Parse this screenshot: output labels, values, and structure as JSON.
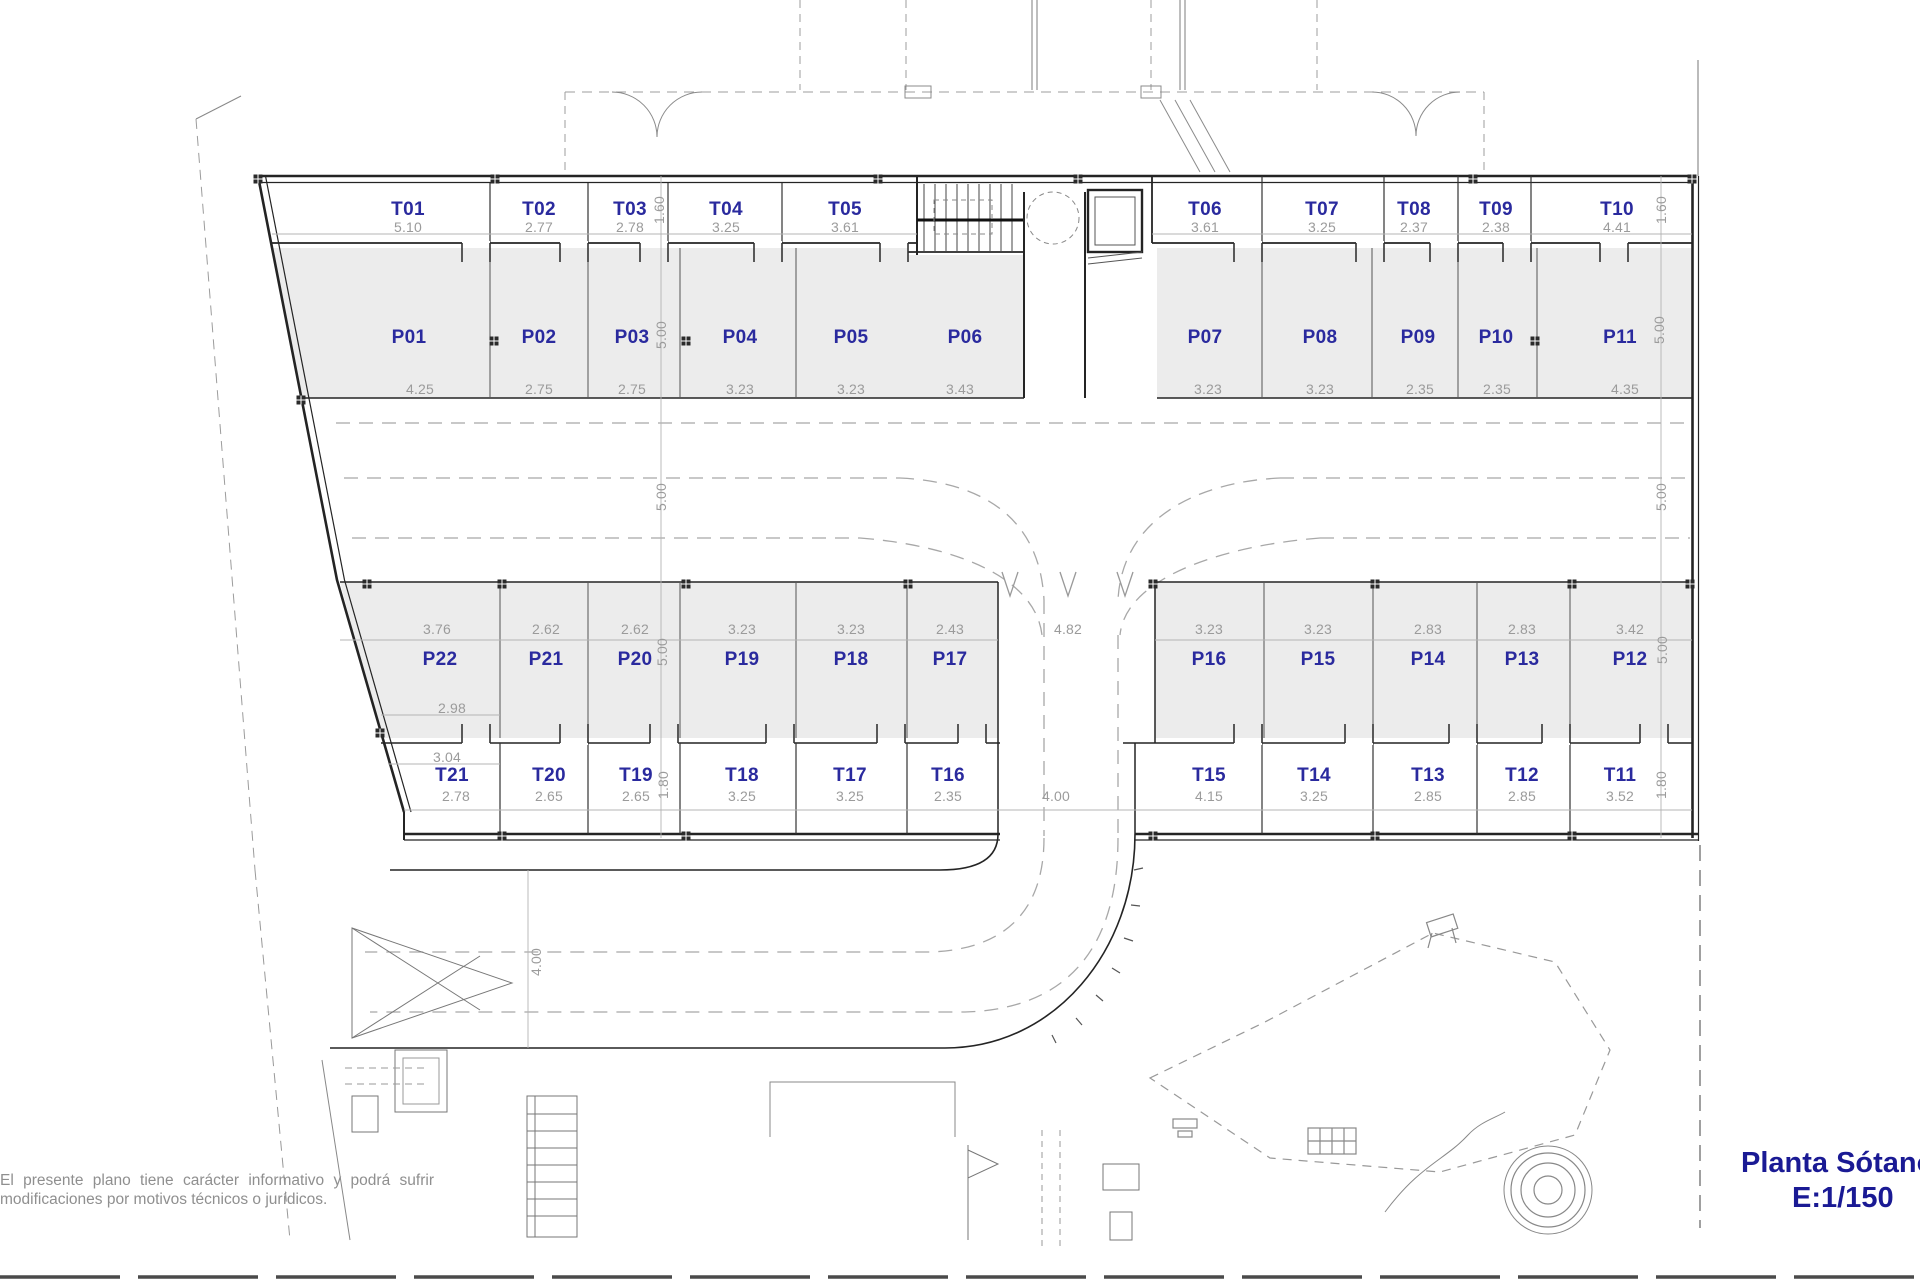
{
  "title": {
    "name": "Planta Sótano",
    "scale": "E:1/150"
  },
  "disclaimer": "El presente plano tiene carácter informativo y podrá sufrir modificaciones por motivos técnicos o jurídicos.",
  "colors": {
    "label_blue": "#2a2a9e",
    "title_blue": "#1a1a94",
    "dim_gray": "#9b9b9b",
    "stall_fill": "#ececec",
    "wall": "#242424"
  },
  "storage_top": [
    {
      "id": "T01",
      "w": "5.10"
    },
    {
      "id": "T02",
      "w": "2.77"
    },
    {
      "id": "T03",
      "w": "2.78"
    },
    {
      "id": "T04",
      "w": "3.25"
    },
    {
      "id": "T05",
      "w": "3.61"
    },
    {
      "id": "T06",
      "w": "3.61"
    },
    {
      "id": "T07",
      "w": "3.25"
    },
    {
      "id": "T08",
      "w": "2.37"
    },
    {
      "id": "T09",
      "w": "2.38"
    },
    {
      "id": "T10",
      "w": "4.41"
    }
  ],
  "parking_top": [
    {
      "id": "P01",
      "w": "4.25"
    },
    {
      "id": "P02",
      "w": "2.75"
    },
    {
      "id": "P03",
      "w": "2.75"
    },
    {
      "id": "P04",
      "w": "3.23"
    },
    {
      "id": "P05",
      "w": "3.23"
    },
    {
      "id": "P06",
      "w": "3.43"
    },
    {
      "id": "P07",
      "w": "3.23"
    },
    {
      "id": "P08",
      "w": "3.23"
    },
    {
      "id": "P09",
      "w": "2.35"
    },
    {
      "id": "P10",
      "w": "2.35"
    },
    {
      "id": "P11",
      "w": "4.35"
    }
  ],
  "parking_bottom": [
    {
      "id": "P22",
      "w": "3.76"
    },
    {
      "id": "P21",
      "w": "2.62"
    },
    {
      "id": "P20",
      "w": "2.62"
    },
    {
      "id": "P19",
      "w": "3.23"
    },
    {
      "id": "P18",
      "w": "3.23"
    },
    {
      "id": "P17",
      "w": "2.43"
    },
    {
      "id": "P16",
      "w": "3.23"
    },
    {
      "id": "P15",
      "w": "3.23"
    },
    {
      "id": "P14",
      "w": "2.83"
    },
    {
      "id": "P13",
      "w": "2.83"
    },
    {
      "id": "P12",
      "w": "3.42"
    }
  ],
  "storage_bottom": [
    {
      "id": "T21",
      "w": "2.78"
    },
    {
      "id": "T20",
      "w": "2.65"
    },
    {
      "id": "T19",
      "w": "2.65"
    },
    {
      "id": "T18",
      "w": "3.25"
    },
    {
      "id": "T17",
      "w": "3.25"
    },
    {
      "id": "T16",
      "w": "2.35"
    },
    {
      "id": "T15",
      "w": "4.15"
    },
    {
      "id": "T14",
      "w": "3.25"
    },
    {
      "id": "T13",
      "w": "2.85"
    },
    {
      "id": "T12",
      "w": "2.85"
    },
    {
      "id": "T11",
      "w": "3.52"
    }
  ],
  "dims": {
    "storage_depth_top": "1.60",
    "parking_depth_top": "5.00",
    "aisle_width": "5.00",
    "parking_depth_bottom": "5.00",
    "storage_depth_bottom": "1.80",
    "ramp_bottom": "4.82",
    "ramp_exit": "4.00",
    "road_width": "4.00",
    "p22_front": "2.98",
    "p22_outer": "3.04"
  }
}
